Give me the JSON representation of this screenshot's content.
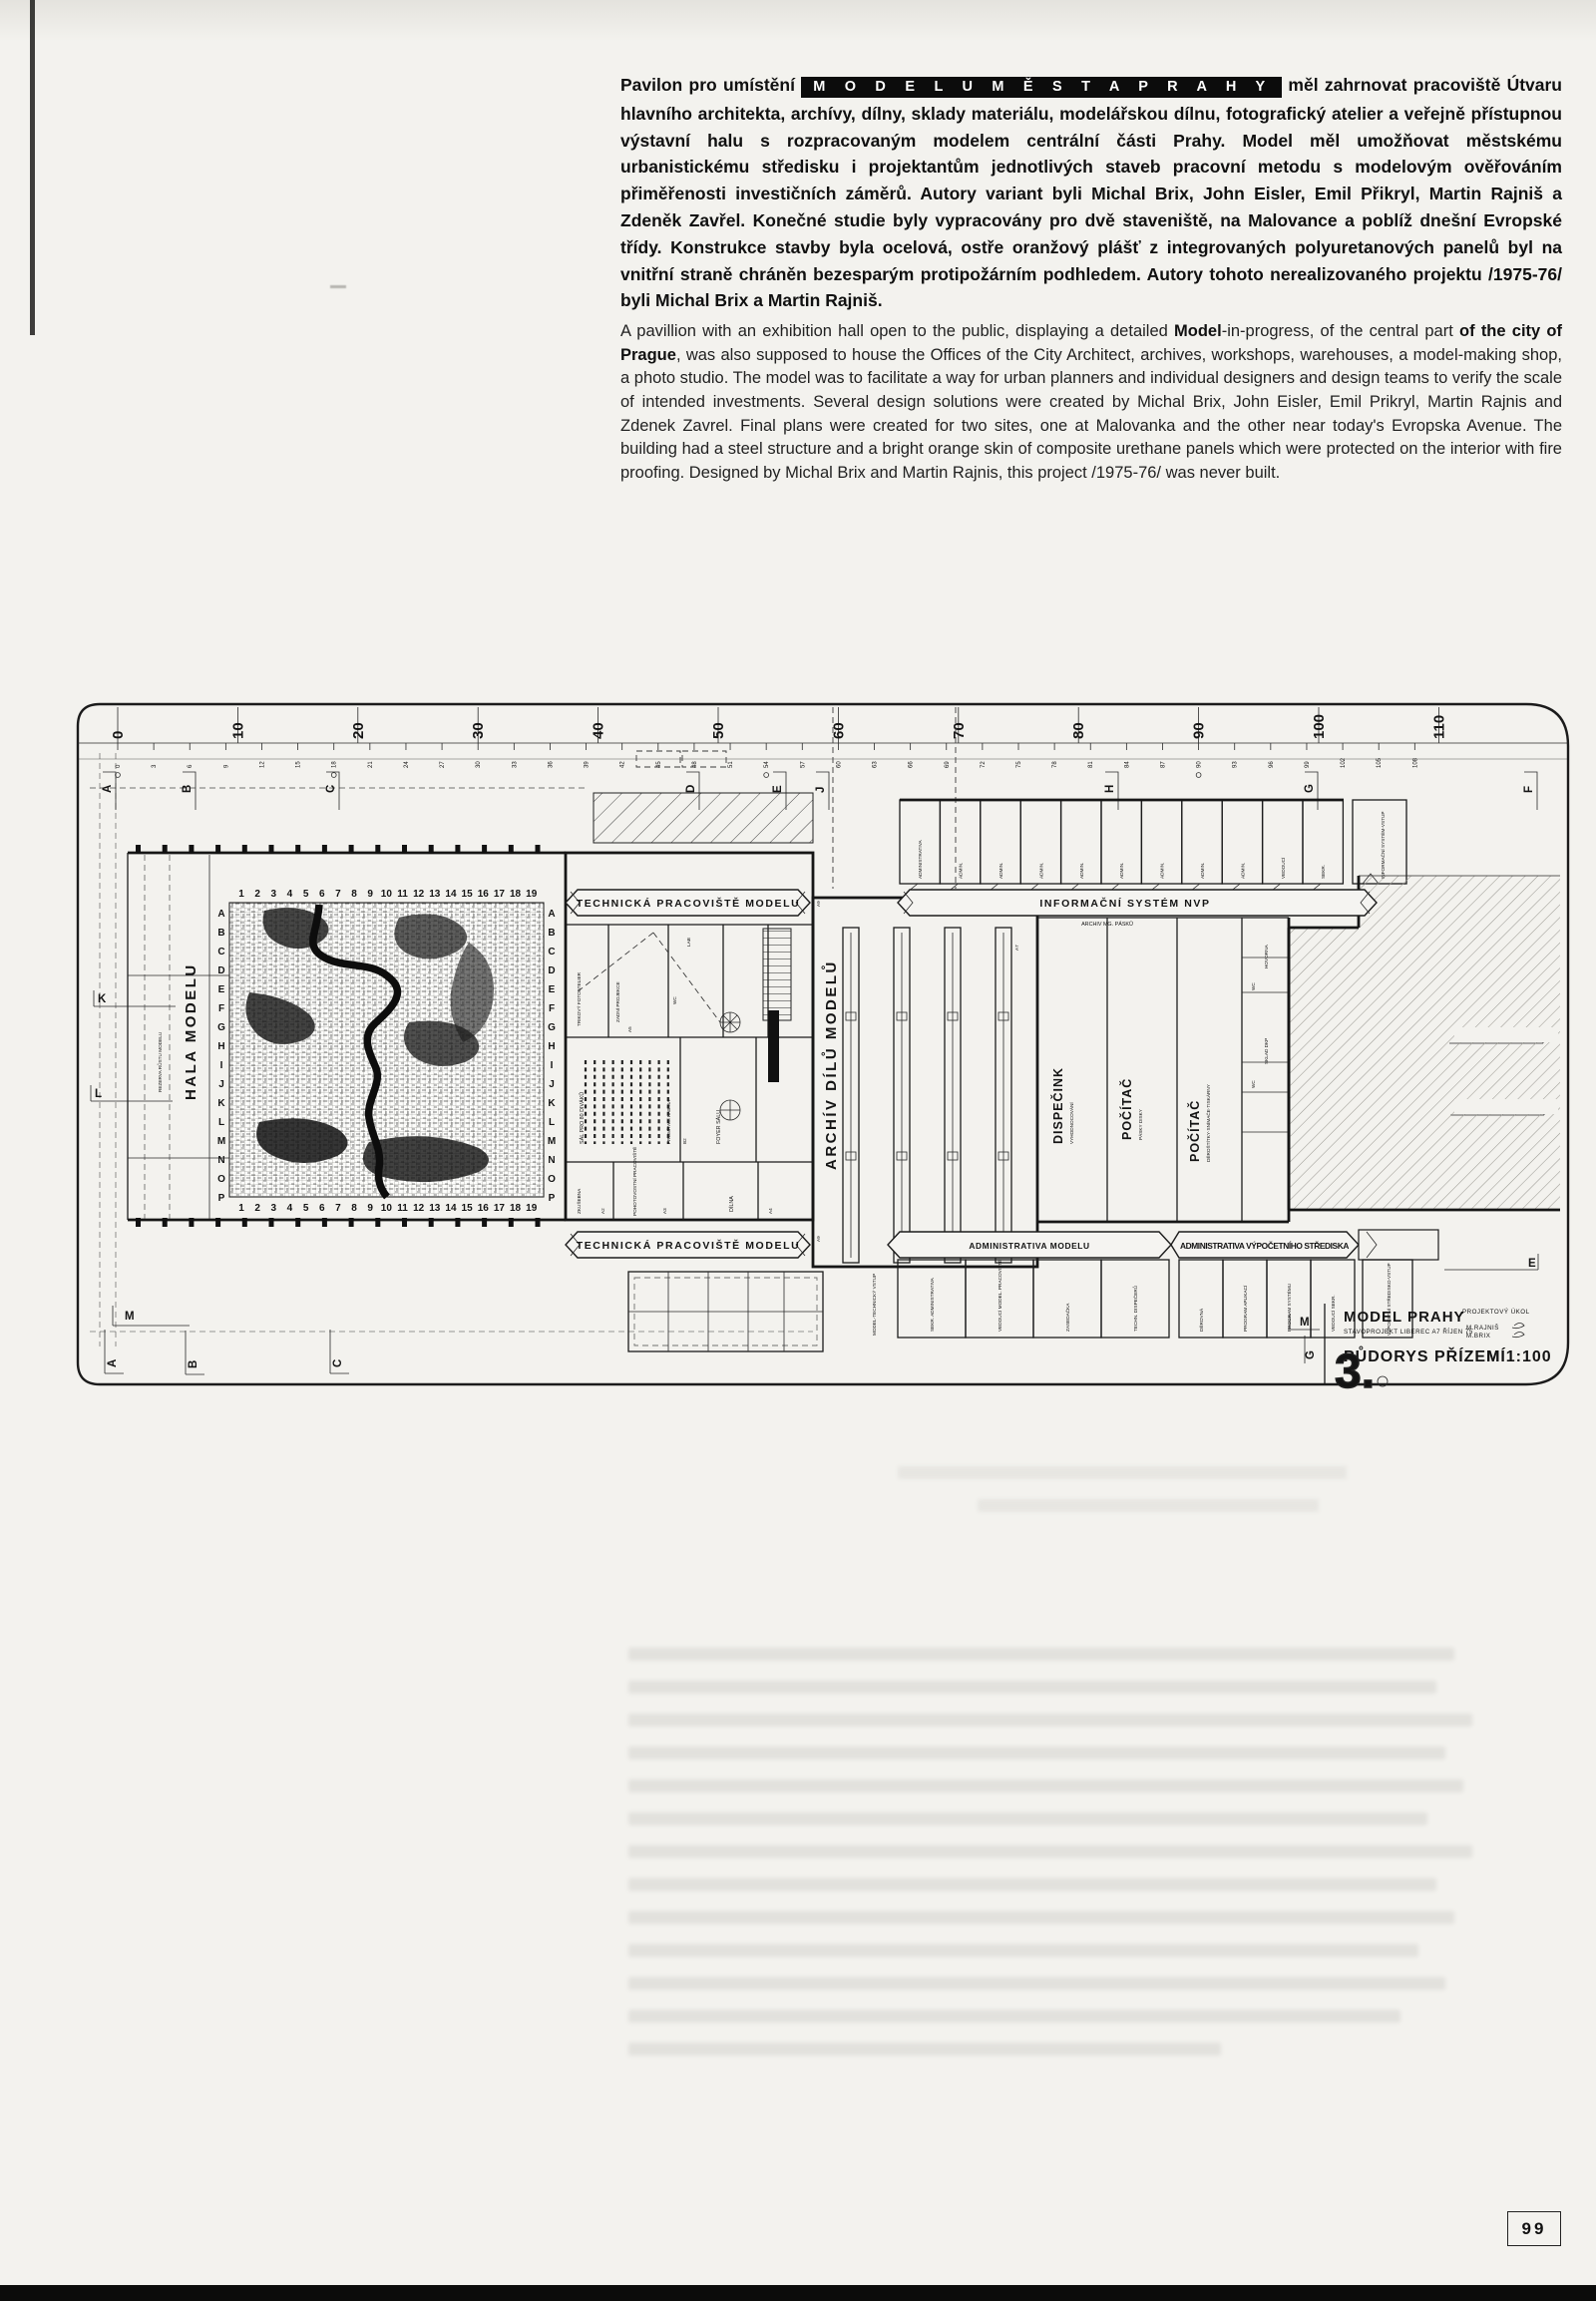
{
  "page": {
    "number": "99"
  },
  "article": {
    "czech": {
      "lead": "Pavilon pro umístění ",
      "highlight": "M O D E L U   M Ě S T A   P R A H Y",
      "body": " měl zahrnovat pracoviště Útvaru hlavního architekta, archívy, dílny, sklady materiálu, modelářskou dílnu, fotografický atelier a veřejně přístupnou výstavní halu s rozpracovaným modelem centrální části Prahy. Model měl umožňovat městskému urbanistickému středisku i projektantům jednotlivých staveb pracovní metodu s modelovým ověřováním přiměřenosti investičních záměrů. Autory variant byli Michal Brix, John Eisler, Emil Přikryl, Martin Rajniš a Zdeněk Zavřel. Konečné studie byly vypracovány pro dvě staveniště, na Malovance a poblíž dnešní Evropské třídy. Konstrukce stavby byla ocelová, ostře oranžový plášť z integrovaných polyuretanových panelů byl na vnitřní straně chráněn bezesparým protipožárním podhledem. Autory tohoto nerealizovaného projektu /1975-76/ byli Michal Brix a Martin Rajniš."
    },
    "english": {
      "s1": "A pavillion with an exhibition hall open to the public, displaying a detailed ",
      "b1": "Model",
      "s2": "-in-progress, of the central part ",
      "b2": "of the city of Prague",
      "s3": ", was also supposed to house the Offices of the City Architect, archives, workshops, warehouses, a model-making shop, a photo studio. The model was to facilitate a way for urban planners and individual designers and design teams to verify the scale of intended investments. Several design solutions were created by Michal Brix, John Eisler, Emil Prikryl, Martin Rajnis and Zdenek Zavrel. Final plans were created for two sites, one at Malovanka and the other near today's Evropska Avenue. The building had a steel structure and a bright orange skin of composite urethane panels which were protected on the interior with fire proofing. Designed by Michal Brix and Martin Rajnis, this project /1975-76/ was never built."
    }
  },
  "plan": {
    "ruler_major": [
      "0",
      "10",
      "20",
      "30",
      "40",
      "50",
      "60",
      "70",
      "80",
      "90",
      "100",
      "110"
    ],
    "ruler_minor": [
      "0",
      "3",
      "6",
      "9",
      "12",
      "15",
      "18",
      "21",
      "24",
      "27",
      "30",
      "33",
      "36",
      "39",
      "42",
      "45",
      "48",
      "51",
      "54",
      "57",
      "60",
      "63",
      "66",
      "69",
      "72",
      "75",
      "78",
      "81",
      "84",
      "87",
      "90",
      "93",
      "96",
      "99",
      "102",
      "105",
      "108"
    ],
    "grid_cols": [
      "1",
      "2",
      "3",
      "4",
      "5",
      "6",
      "7",
      "8",
      "9",
      "10",
      "11",
      "12",
      "13",
      "14",
      "15",
      "16",
      "17",
      "18",
      "19"
    ],
    "grid_rows": [
      "A",
      "B",
      "C",
      "D",
      "E",
      "F",
      "G",
      "H",
      "I",
      "J",
      "K",
      "L",
      "M",
      "N",
      "O",
      "P"
    ],
    "markers_top": [
      "A",
      "B",
      "C",
      "D",
      "E",
      "J",
      "H",
      "G",
      "F"
    ],
    "markers_left": [
      "K",
      "L"
    ],
    "markers_right": [
      "K",
      "L",
      "E"
    ],
    "markers_bottom": [
      "M",
      "A",
      "B",
      "C"
    ],
    "markers_title": [
      "M",
      "G"
    ],
    "labels": {
      "hala": "HALA MODELU",
      "rezerva": "REZERVA RŮSTU MODELU",
      "tech_top": "TECHNICKÁ PRACOVIŠTĚ MODELU",
      "tech_bottom": "TECHNICKÁ PRACOVIŠTĚ MODELU",
      "archiv": "ARCHÍV DÍLŮ MODELŮ",
      "info": "INFORMAČNÍ SYSTÉM NVP",
      "archiv_mg": "ARCHIV MG. PÁSKŮ",
      "dispecink": "DISPEČINK",
      "dispecink_sub": "VYHODNOCOVÁNÍ",
      "pocitac1": "POČÍTAČ",
      "pocitac1_sub": "PÁSKY DISKY",
      "pocitac2": "POČÍTAČ",
      "pocitac2_sub": "DĚROŠTÍTKY·SNÍMAČE·TISKÁRNY",
      "admin_modelu": "ADMINISTRATIVA MODELU",
      "admin_vs": "ADMINISTRATIVA VÝPOČETNÍHO STŘEDISKA",
      "trikovy": "TRIKOVÝ FOTOATELIER",
      "zadni": "ZADNÍ PROJEKCE",
      "sal": "SÁL PRO 80 DIVÁKŮ",
      "foyer": "FOYER SÁLU",
      "promitaci": "PROMÍTACÍ KABINA",
      "lab": "LAB",
      "wc": "WC",
      "zkusebna": "ZKUŠEBNA",
      "pohotovostni": "POHOTOVOSTNÍ PRACOVIŠTĚ",
      "dilna": "DÍLNA",
      "hovorna": "HOVORNA",
      "sklad_dkp": "SKLAD DKP",
      "model_vstup": "MODEL-TECHNICKÝ VSTUP",
      "vs_vstup": "VÝPOČETNÍ STŘEDISKO-VSTUP",
      "info_vstup": "INFORMAČNÍ SYSTÉM-VSTUP"
    },
    "admin_top_cells": [
      "ADMINISTRATIVA",
      "ADMIN.",
      "ADMIN.",
      "ADMIN.",
      "ADMIN.",
      "ADMIN.",
      "ADMIN.",
      "ADMIN.",
      "ADMIN.",
      "VEDOUCÍ",
      "SEKR."
    ],
    "rooms_bottom_left": [
      "SEKR. ADMINISTRATIVA",
      "VEDOUCÍ MODEL. PRACOVIŠTĚ",
      "ZASEDAČKA",
      "TECHN. DISPEČERŮ"
    ],
    "rooms_bottom_right": [
      "DĚROVNÁ",
      "PROGRAM APLIKACÍ",
      "PROGRAM SYSTÉMU",
      "VEDOUCÍ SEKR."
    ],
    "codes": {
      "a2": "A2",
      "a3": "A3",
      "a4": "A4",
      "a5": "A5",
      "a6": "A6",
      "a7": "A7",
      "a9": "A9",
      "b2": "B2",
      "c5": "C5",
      "d5": "D5"
    }
  },
  "title_block": {
    "project": "MODEL PRAHY",
    "task": "PROJEKTOVÝ ÚKOL",
    "office": "STAVOPROJEKT LIBEREC A7   ŘÍJEN 75",
    "author1": "M.RAJNIŠ",
    "author2": "M.BRIX",
    "drawing": "PŮDORYS PŘÍZEMÍ",
    "scale": "M 1:100",
    "sheet": "3."
  }
}
